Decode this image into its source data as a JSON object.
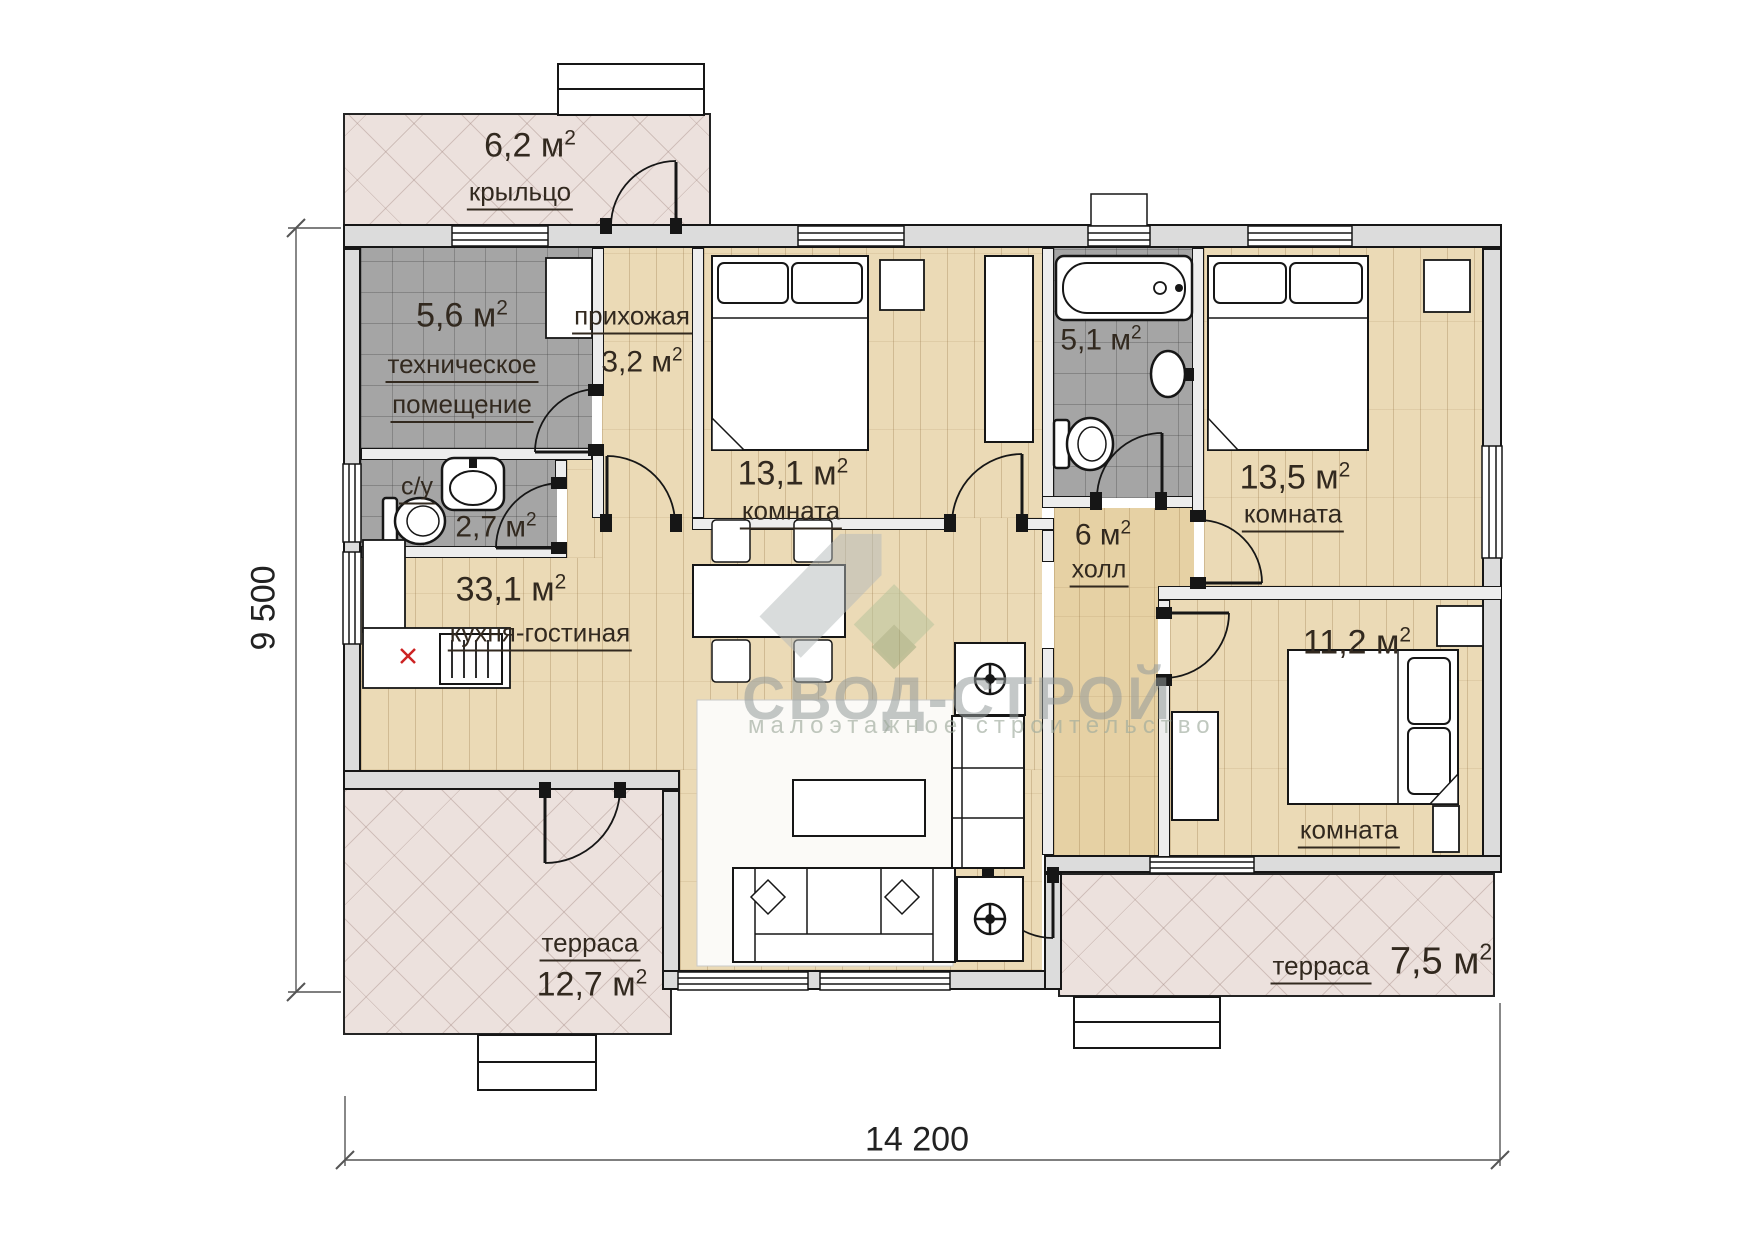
{
  "watermark": {
    "title": "СВОД-СТРОЙ",
    "subtitle": "малоэтажное строительство"
  },
  "units": {
    "m": "м",
    "sup": "2"
  },
  "dimensions": {
    "width": "14 200",
    "height": "9 500"
  },
  "rooms": {
    "porch": {
      "area": "6,2",
      "name": "крыльцо"
    },
    "tech": {
      "area": "5,6",
      "name1": "техническое",
      "name2": "помещение"
    },
    "hallway": {
      "area": "3,2",
      "name": "прихожая"
    },
    "bedroom1": {
      "area": "13,1",
      "name": "комната"
    },
    "bath": {
      "area": "5,1"
    },
    "bedroom2": {
      "area": "13,5",
      "name": "комната"
    },
    "wc": {
      "area": "2,7",
      "name": "с/у"
    },
    "kitchen": {
      "area": "33,1",
      "name": "кухня-гостиная"
    },
    "hall": {
      "area": "6",
      "name": "холл"
    },
    "bedroom3": {
      "area": "11,2",
      "name": "комната"
    },
    "terrace_left": {
      "area": "12,7",
      "name": "терраса"
    },
    "terrace_right": {
      "area": "7,5",
      "name": "терраса"
    }
  }
}
